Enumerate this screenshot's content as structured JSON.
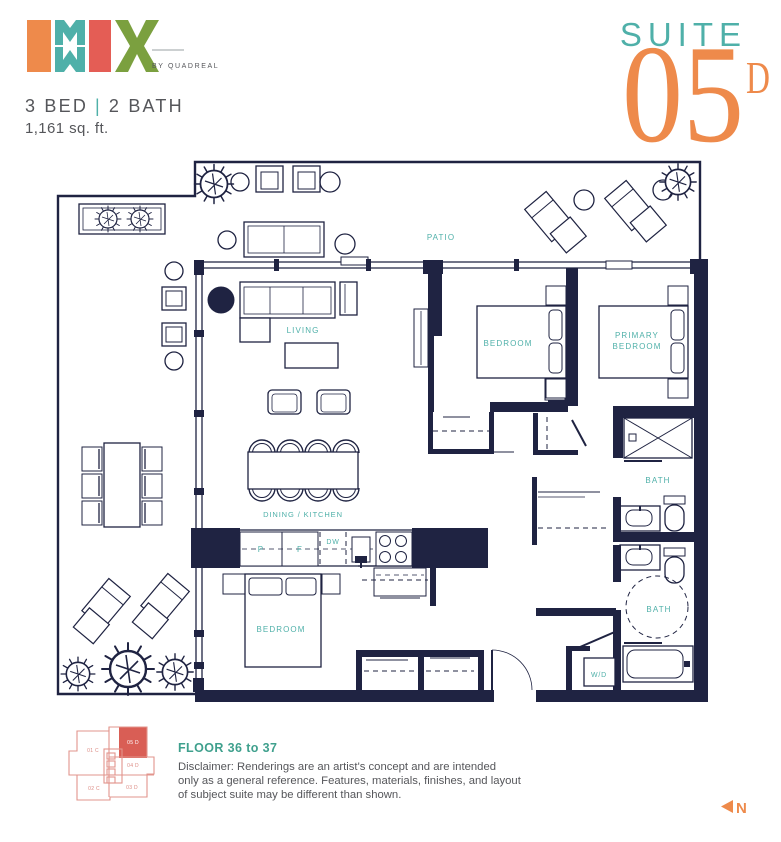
{
  "colors": {
    "navy": "#1f2342",
    "teal": "#4fb0a9",
    "orange": "#ee8a4b",
    "coral": "#e45d55",
    "green": "#7ba03f",
    "gray": "#55565a",
    "floor_teal": "#3fa08d",
    "keyplan_outline": "#e2948c",
    "keyplan_highlight": "#d95e55"
  },
  "header": {
    "logo": {
      "byline": "BY QUADREAL"
    },
    "spec": {
      "beds": "3 BED",
      "separator": "|",
      "baths": "2 BATH",
      "area": "1,161 sq. ft."
    },
    "suite": {
      "label": "SUITE",
      "number": "05",
      "letter": "D"
    }
  },
  "plan": {
    "labels": {
      "patio": "PATIO",
      "living": "LIVING",
      "bedroom_top": "BEDROOM",
      "primary_line1": "PRIMARY",
      "primary_line2": "BEDROOM",
      "bath_top": "BATH",
      "dining_kitchen": "DINING / KITCHEN",
      "bedroom_bottom": "BEDROOM",
      "bath_bottom": "BATH",
      "washer_dryer": "W/D",
      "pantry": "P",
      "fridge": "F",
      "dishwasher": "DW"
    }
  },
  "footer": {
    "keyplan": {
      "unit_01": "01 C",
      "unit_05": "05 D",
      "unit_04": "04 D",
      "unit_02": "02 C",
      "unit_03": "03 D"
    },
    "floor_range": "FLOOR 36 to 37",
    "disclaimer": [
      "Disclaimer: Renderings are an artist's concept and are intended",
      "only as a general reference. Features, materials, finishes, and layout",
      "of subject suite may be different than shown."
    ],
    "north_label": "N"
  }
}
